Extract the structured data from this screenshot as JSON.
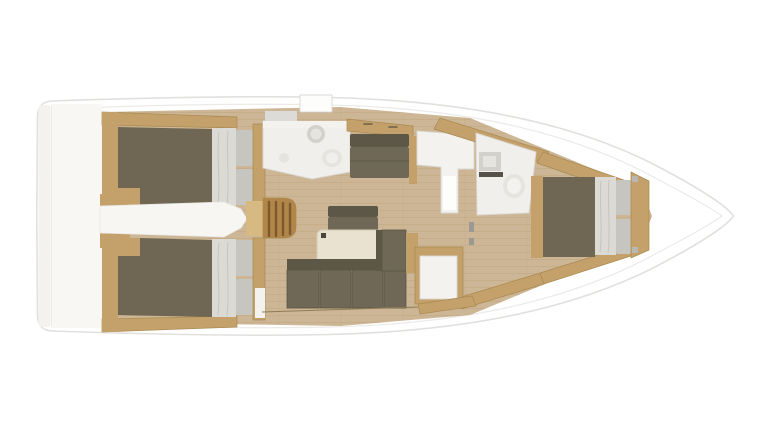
{
  "image": {
    "kind": "sailing-yacht-interior-floorplan",
    "view": "top-down",
    "orientation": "bow-right-stern-left",
    "visible_text": ""
  },
  "regions": [
    {
      "name": "stern-platform",
      "desc": "transom swim platform"
    },
    {
      "name": "aft-cabin-port",
      "desc": "aft double berth, port side"
    },
    {
      "name": "aft-cabin-starboard",
      "desc": "aft double berth, starboard side"
    },
    {
      "name": "companionway",
      "desc": "entry steps and engine-box corridor"
    },
    {
      "name": "head-aft",
      "desc": "aft bathroom with sink and toilet"
    },
    {
      "name": "salon",
      "desc": "settee, table, L-shaped sofa"
    },
    {
      "name": "galley-unit",
      "desc": "white L-shaped counter"
    },
    {
      "name": "head-forward",
      "desc": "forward bathroom with sink and toilet"
    },
    {
      "name": "forward-cabin",
      "desc": "V-berth double bed at bow"
    }
  ],
  "colors": {
    "background": "#ffffff",
    "hull_fill": "#ffffff",
    "transom_step": "#f3f2ef",
    "garage": "#f8f7f4",
    "floor": "#cdb695",
    "plank_line": "#b9a179",
    "wood": "#c4a16b",
    "wood_light": "#d7ba82",
    "steps": "#b28649",
    "blanket": "#6f6754",
    "sheet": "#dcdad4",
    "pillow": "#c7c5bf",
    "upholstery": "#6f6856",
    "upholstery_dark": "#5d5747",
    "corridor_white": "#f7f6f2",
    "bath_white": "#f0efec",
    "panel_white": "#f3f2ef",
    "fixture_grey": "#d3d1cb",
    "fixture_light": "#e6e4df",
    "grey_band": "#dcdbd7",
    "hatch_white": "#fdfdfc",
    "dark_slot": "#56524a",
    "jamb_grey": "#9b9993",
    "table": "#e9e2d0",
    "leg_dark": "#4a463c",
    "bracket_grey": "#b9b7b1"
  }
}
